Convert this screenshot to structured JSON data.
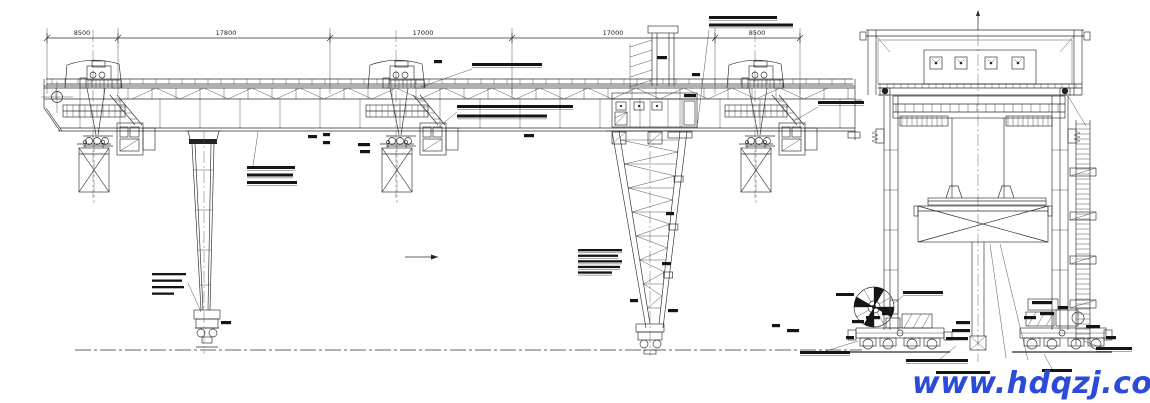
{
  "drawing": {
    "background": "#ffffff",
    "line_color": "#2b2b2b",
    "description_colors": {
      "watermark_blue": "#2b4bd8"
    }
  },
  "dims": [
    "8500",
    "17800",
    "17000",
    "17000",
    "8500"
  ],
  "watermark": {
    "text": "www.hdqzj.com",
    "color": "#2b4bd8"
  },
  "annotations": {
    "blocks": [
      {
        "x": 709,
        "y": 16,
        "lh": 7.5,
        "lines": [
          68,
          84
        ],
        "ul": true,
        "leader": [
          709,
          30,
          697,
          128
        ]
      },
      {
        "x": 472,
        "y": 63,
        "lh": 9,
        "lines": [
          70
        ],
        "ul": true,
        "leader": [
          472,
          69,
          421,
          87
        ]
      },
      {
        "x": 457,
        "y": 105,
        "lh": 9.5,
        "lines": [
          116,
          90
        ],
        "ul": true,
        "leader": [
          457,
          112,
          440,
          126
        ]
      },
      {
        "x": 247,
        "y": 166,
        "lh": 7.5,
        "lines": [
          48,
          46,
          50
        ],
        "ul": true,
        "leader": [
          253,
          166,
          258,
          132
        ]
      },
      {
        "x": 152,
        "y": 273,
        "lh": 6.5,
        "lines": [
          34,
          30,
          32,
          22
        ],
        "ul": false,
        "leader": [
          188,
          283,
          201,
          312
        ]
      },
      {
        "x": 578,
        "y": 249,
        "lh": 5.6,
        "lines": [
          44,
          40,
          44,
          42,
          34
        ],
        "ul": true
      },
      {
        "x": 818,
        "y": 101,
        "lh": 8,
        "lines": [
          46
        ],
        "ul": true,
        "leader": [
          818,
          107,
          794,
          121
        ]
      },
      {
        "x": 903,
        "y": 291,
        "lh": 7,
        "lines": [
          40
        ],
        "ul": true,
        "leader": [
          903,
          296,
          893,
          304
        ]
      },
      {
        "x": 836,
        "y": 293,
        "lh": 7,
        "lines": [
          18
        ],
        "ul": false,
        "leader": [
          855,
          297,
          866,
          305
        ]
      },
      {
        "x": 800,
        "y": 351,
        "lh": 8,
        "lines": [
          50
        ],
        "ul": true,
        "leader": [
          826,
          351,
          858,
          341
        ]
      },
      {
        "x": 906,
        "y": 359,
        "lh": 8,
        "lines": [
          62
        ],
        "ul": true,
        "leader": [
          940,
          359,
          956,
          346
        ]
      },
      {
        "x": 1096,
        "y": 347,
        "lh": 8,
        "lines": [
          36
        ],
        "ul": true,
        "leader": [
          1100,
          347,
          1084,
          341
        ]
      },
      {
        "x": 1042,
        "y": 369,
        "lh": 8,
        "lines": [
          30
        ],
        "ul": false,
        "leader": [
          1052,
          369,
          1044,
          354
        ]
      },
      {
        "x": 936,
        "y": 371,
        "lh": 8,
        "lines": [
          54
        ],
        "ul": false
      }
    ],
    "tiny": [
      [
        221,
        321,
        10
      ],
      [
        308,
        135,
        9
      ],
      [
        323,
        133,
        7
      ],
      [
        323,
        141,
        7
      ],
      [
        524,
        134,
        10
      ],
      [
        684,
        94,
        12
      ],
      [
        657,
        56,
        10
      ],
      [
        692,
        73,
        8
      ],
      [
        666,
        212,
        8
      ],
      [
        662,
        262,
        9
      ],
      [
        630,
        299,
        8
      ],
      [
        668,
        309,
        10
      ],
      [
        358,
        143,
        12
      ],
      [
        360,
        150,
        10
      ],
      [
        434,
        60,
        8
      ],
      [
        852,
        320,
        12
      ],
      [
        866,
        316,
        14
      ],
      [
        882,
        312,
        10
      ],
      [
        846,
        336,
        8
      ],
      [
        772,
        324,
        8
      ],
      [
        787,
        329,
        12
      ],
      [
        956,
        321,
        14
      ],
      [
        952,
        329,
        18
      ],
      [
        946,
        337,
        22
      ],
      [
        1024,
        316,
        12
      ],
      [
        1040,
        312,
        14
      ],
      [
        1058,
        306,
        10
      ],
      [
        1086,
        325,
        14
      ],
      [
        1106,
        336,
        10
      ],
      [
        1032,
        301,
        20
      ]
    ]
  }
}
